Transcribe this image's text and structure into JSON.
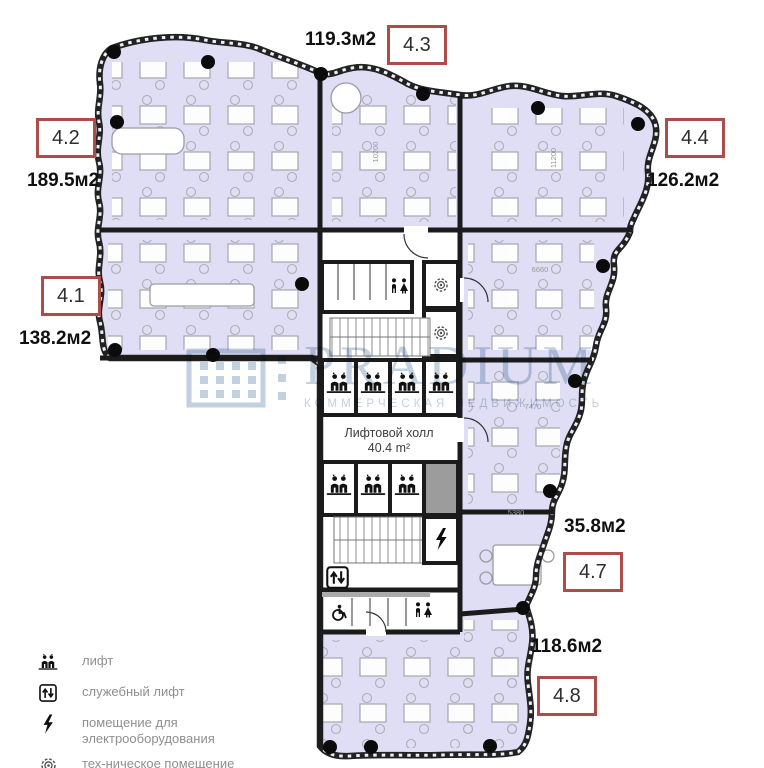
{
  "plan": {
    "lift_hall_line1": "Лифтовой холл",
    "lift_hall_line2": "40.4 m²",
    "dims": {
      "d1": "10200",
      "d2": "11200",
      "d3": "6660",
      "d4": "7470",
      "d5": "5380"
    }
  },
  "units": {
    "u43": {
      "num": "4.3",
      "area": "119.3м2"
    },
    "u42": {
      "num": "4.2",
      "area": "189.5м2"
    },
    "u41": {
      "num": "4.1",
      "area": "138.2м2"
    },
    "u44": {
      "num": "4.4",
      "area": "126.2м2"
    },
    "u47": {
      "num": "4.7",
      "area": "35.8м2"
    },
    "u48": {
      "num": "4.8",
      "area": "118.6м2"
    }
  },
  "legend": {
    "lift": "лифт",
    "service_lift": "служебный лифт",
    "electrical_line1": "помещение для",
    "electrical_line2": "электрооборудования",
    "technical": "тех-ническое помещение"
  },
  "watermark": {
    "brand": "PRADIUM",
    "subtitle": "КОММЕРЧЕСКАЯ НЕДВИЖИМОСТЬ"
  },
  "colors": {
    "room_fill": "#dfdef4",
    "wall": "#1b1b1b",
    "unit_box_border": "#ac4d4a",
    "watermark": "#b9cbdb"
  }
}
